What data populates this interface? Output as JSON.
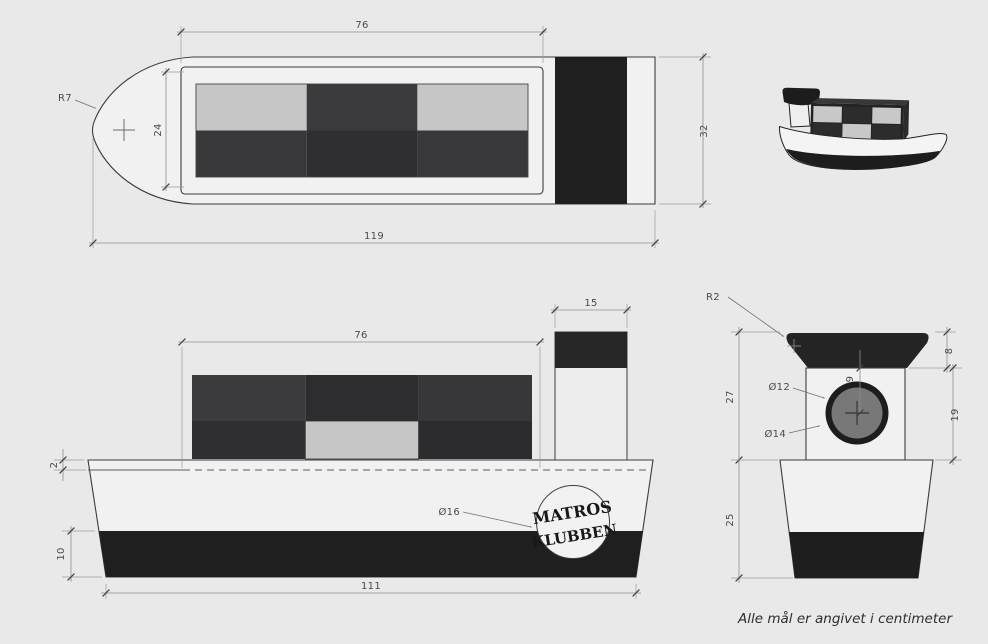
{
  "note": "Alle mål er angivet i centimeter",
  "top_view": {
    "cabin_width": "76",
    "inner_width": "24",
    "bow_radius": "R7",
    "overall_length": "119",
    "overall_width": "32"
  },
  "side_view": {
    "cabin_width": "76",
    "funnel_width": "15",
    "deck_thickness": "2",
    "bottom_band_height": "10",
    "keel_length": "111",
    "logo_diameter": "Ø16"
  },
  "front_view": {
    "corner_radius": "R2",
    "cap_height": "8",
    "porthole_offset": "9",
    "porthole_inner_diameter": "Ø12",
    "porthole_outer_diameter": "Ø14",
    "structure_height": "27",
    "body_height": "19",
    "hull_height": "25"
  },
  "logo": {
    "top": "MATROS",
    "bottom": "KLUBBEN"
  },
  "colors": {
    "background": "#e9e9e9",
    "paper_light": "#f1f1f1",
    "ink_black": "#1f1f1f",
    "cell_dark": "#333336",
    "cell_light": "#c6c6c6",
    "dimension_line": "#8f8f8f",
    "text": "#4a4a4a"
  }
}
